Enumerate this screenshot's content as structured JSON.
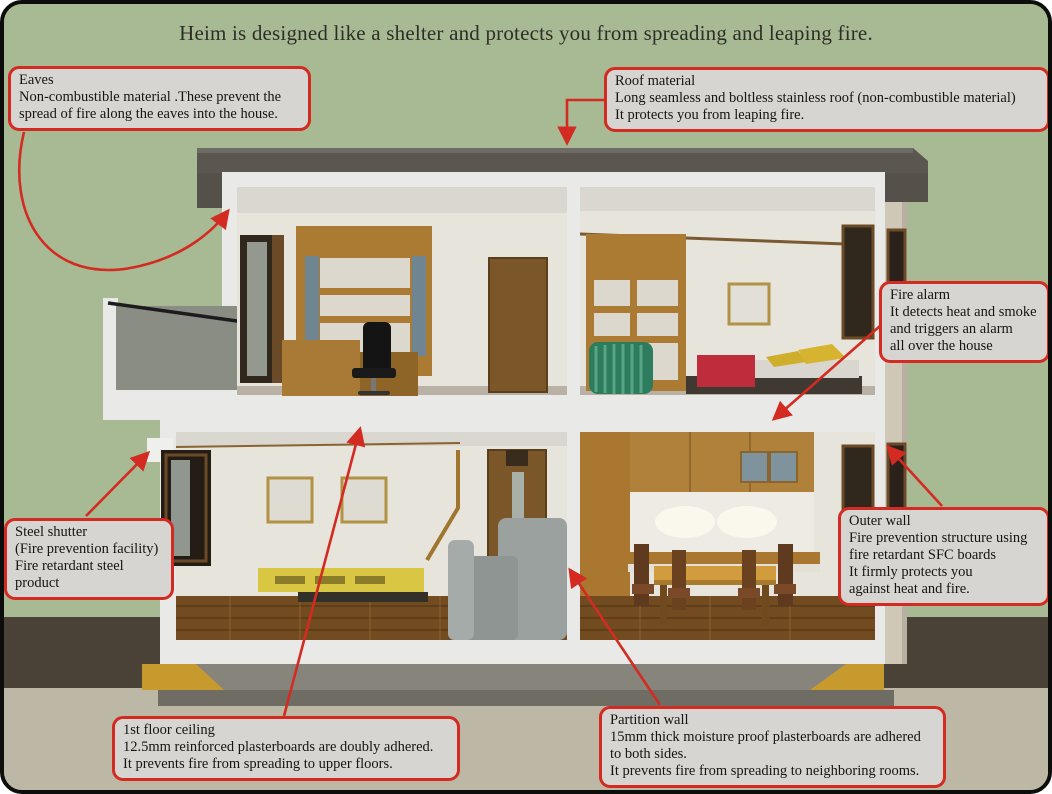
{
  "title": "Heim is designed like a shelter and protects you from spreading and leaping fire.",
  "colors": {
    "background_green": "#a7ba93",
    "ground_dark_band": "#4b4237",
    "ground_beige": "#bdb8a5",
    "callout_background": "#d6d5d2",
    "callout_border_red": "#d32b21",
    "arrow_red": "#d32b21",
    "roof_gray": "#5b5650",
    "house_white": "#e9e9e7",
    "wood_brown": "#ab7b33",
    "floor_brown": "#734b20",
    "foundation_gray": "#87847b",
    "foundation_yellow": "#c79a2e"
  },
  "callouts": {
    "eaves": {
      "lines": [
        "Eaves",
        "Non-combustible material .These prevent the",
        "spread of fire along the eaves into the house."
      ]
    },
    "roof_material": {
      "lines": [
        "Roof material",
        "Long seamless and boltless stainless roof (non-combustible material)",
        "It protects you from leaping fire."
      ]
    },
    "fire_alarm": {
      "lines": [
        "Fire alarm",
        "It detects heat and smoke",
        "and triggers an alarm",
        "all over the house"
      ]
    },
    "outer_wall": {
      "lines": [
        "Outer wall",
        "Fire prevention structure using",
        "fire retardant SFC boards",
        "It firmly protects you",
        "against heat and fire."
      ]
    },
    "steel_shutter": {
      "lines": [
        "Steel shutter",
        "(Fire prevention facility)",
        "Fire retardant steel",
        "product"
      ]
    },
    "first_floor_ceiling": {
      "lines": [
        "1st floor ceiling",
        "12.5mm reinforced plasterboards are doubly adhered.",
        "It prevents fire from spreading to upper floors."
      ]
    },
    "partition_wall": {
      "lines": [
        "Partition wall",
        "15mm thick moisture proof plasterboards are adhered",
        "to both sides.",
        "It prevents fire from spreading to neighboring rooms."
      ]
    }
  }
}
